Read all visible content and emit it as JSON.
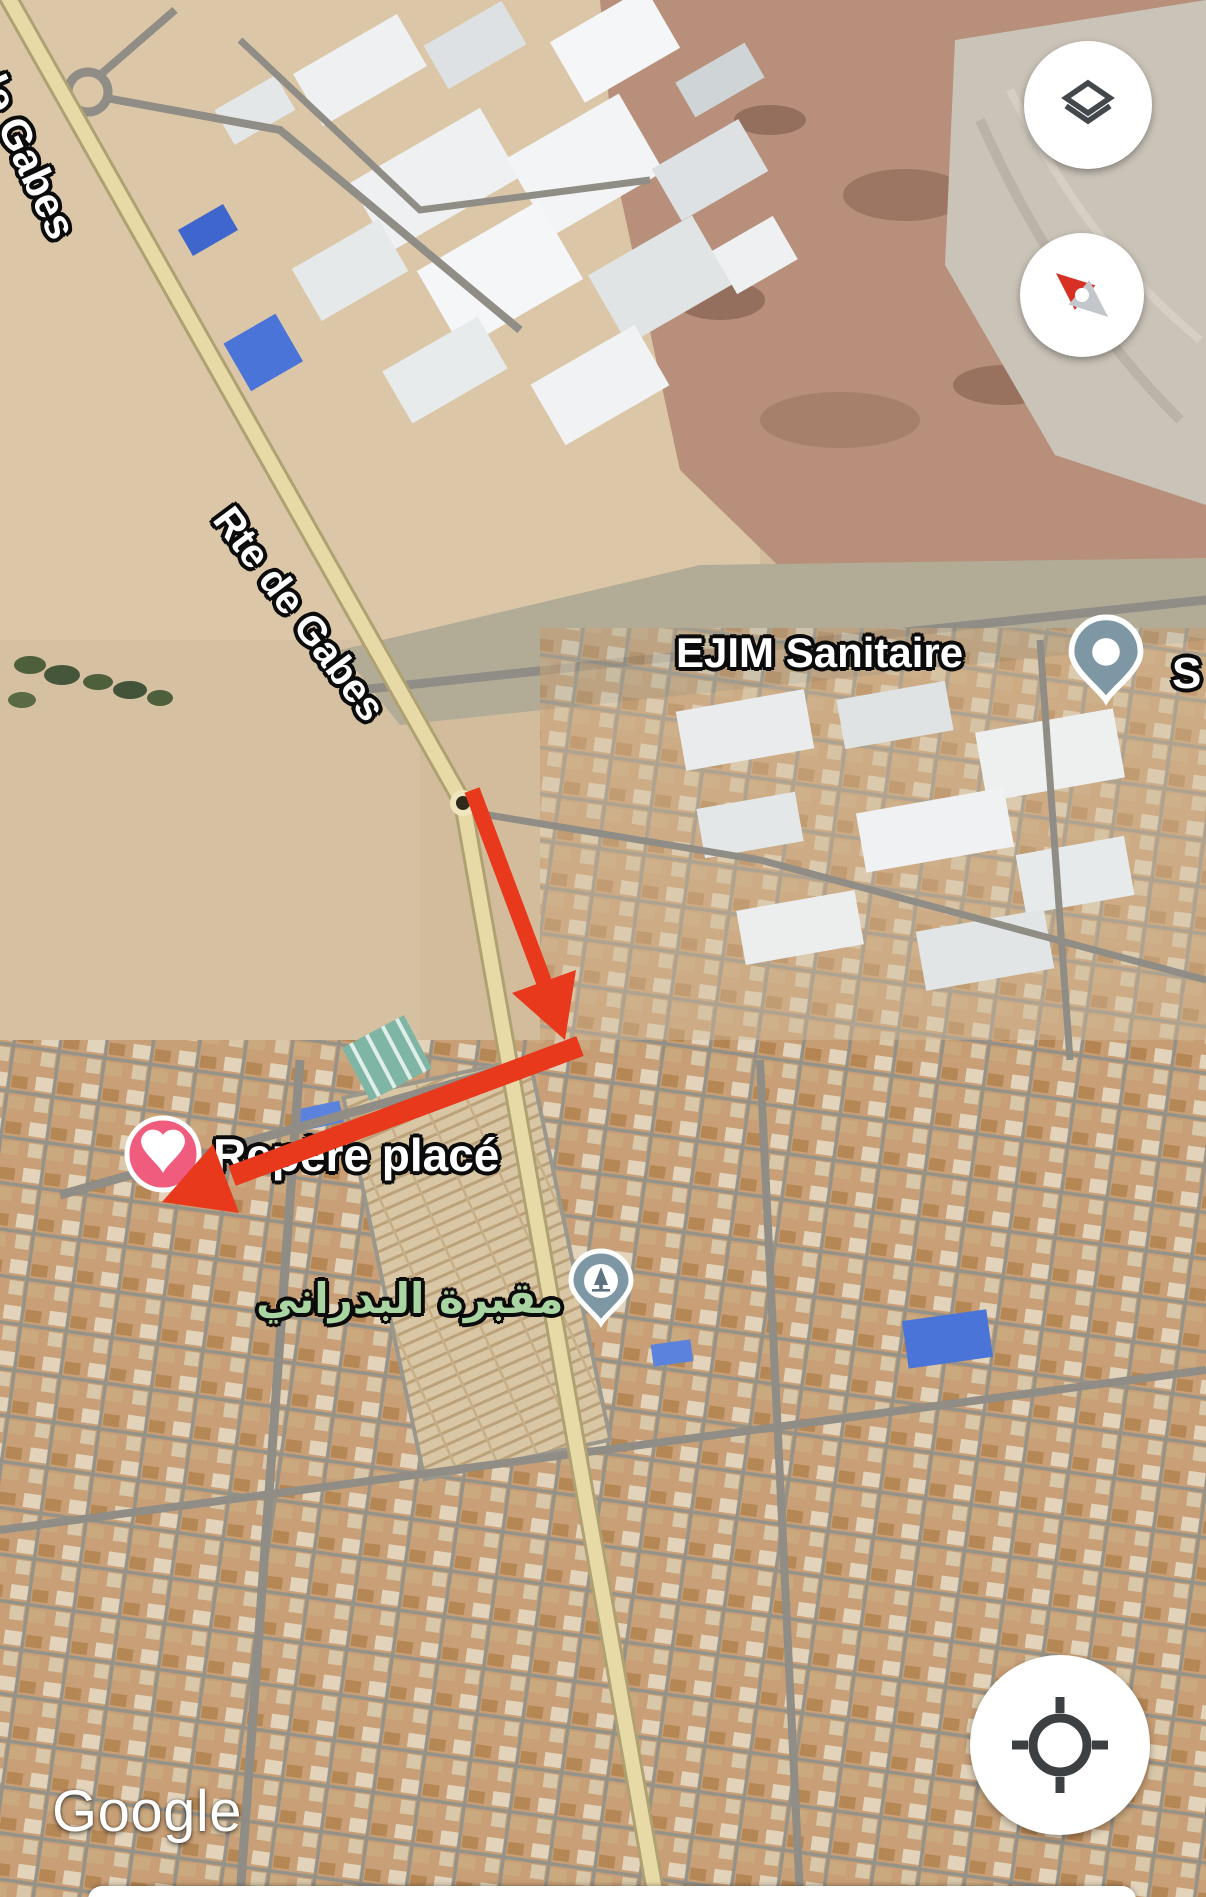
{
  "map": {
    "watermark": "Google",
    "labels": {
      "road_label_top": "de Gabes",
      "road_label_mid": "Rte de Gabes",
      "poi_ejim": "EJIM Sanitaire",
      "poi_truncated_right": "S",
      "dropped_pin_label": "Repère placé",
      "cemetery_label_ar": "مقبرة البدراني"
    },
    "pins": {
      "ejim": {
        "type": "place-pin",
        "color": "#7D97A5"
      },
      "favorite": {
        "type": "heart-pin",
        "color": "#F05C7E"
      },
      "cemetery": {
        "type": "cemetery-pin",
        "color": "#7D97A5"
      },
      "route_dot": {
        "type": "route-point",
        "color": "#2F2A1A"
      }
    },
    "colors": {
      "annotation_red": "#E8391D",
      "road_yellow": "#E8DAA6",
      "road_gray": "#8F8D85",
      "cemetery_label_green": "#A8D5A2",
      "sand": "#D2BC9C",
      "urban_tan": "#C79D73"
    }
  },
  "annotations": {
    "arrow_down": {
      "shape": "arrow",
      "direction": "down",
      "color": "#E8391D"
    },
    "arrow_down_left": {
      "shape": "arrow",
      "direction": "down-left",
      "color": "#E8391D"
    }
  },
  "controls": {
    "layers_button": {
      "icon": "layers"
    },
    "compass_button": {
      "icon": "compass",
      "needle_bearing_deg": -50
    },
    "locate_button": {
      "icon": "my-location"
    }
  }
}
